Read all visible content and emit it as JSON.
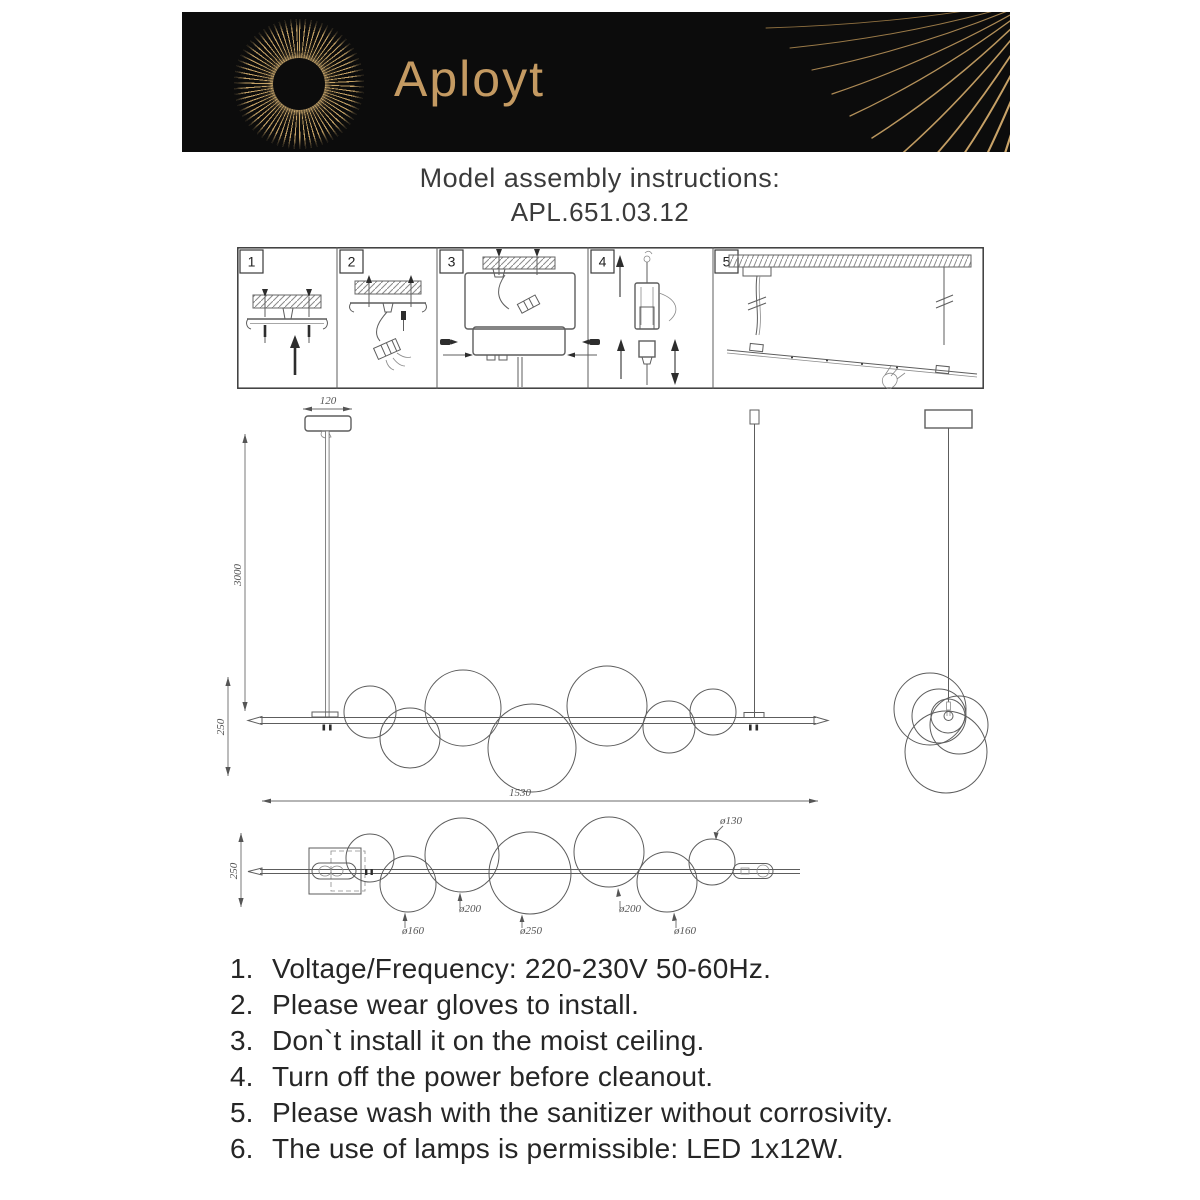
{
  "header": {
    "brand": "Aployt"
  },
  "colors": {
    "banner_bg": "#0c0c0c",
    "gold": "#c49a62",
    "line": "#5d5d5d"
  },
  "title": {
    "heading": "Model assembly instructions:",
    "model": "APL.651.03.12"
  },
  "steps": {
    "labels": [
      "1",
      "2",
      "3",
      "4",
      "5"
    ]
  },
  "diagram": {
    "front_view": {
      "canopy_width": "120",
      "suspension_height": "3000",
      "fixture_height": "250",
      "total_length": "1530"
    },
    "top_view": {
      "fixture_depth": "250",
      "diameters": [
        "ø160",
        "ø200",
        "ø250",
        "ø200",
        "ø160",
        "ø130"
      ]
    }
  },
  "instructions": {
    "items": [
      {
        "num": "1.",
        "text": "Voltage/Frequency: 220-230V 50-60Hz."
      },
      {
        "num": "2.",
        "text": "Please wear gloves to install."
      },
      {
        "num": "3.",
        "text": "Don`t install it on the moist ceiling."
      },
      {
        "num": "4.",
        "text": "Turn off the power before cleanout."
      },
      {
        "num": "5.",
        "text": "Please wash with the sanitizer without corrosivity."
      },
      {
        "num": "6.",
        "text": "The use of lamps is permissible: LED 1x12W."
      }
    ]
  }
}
